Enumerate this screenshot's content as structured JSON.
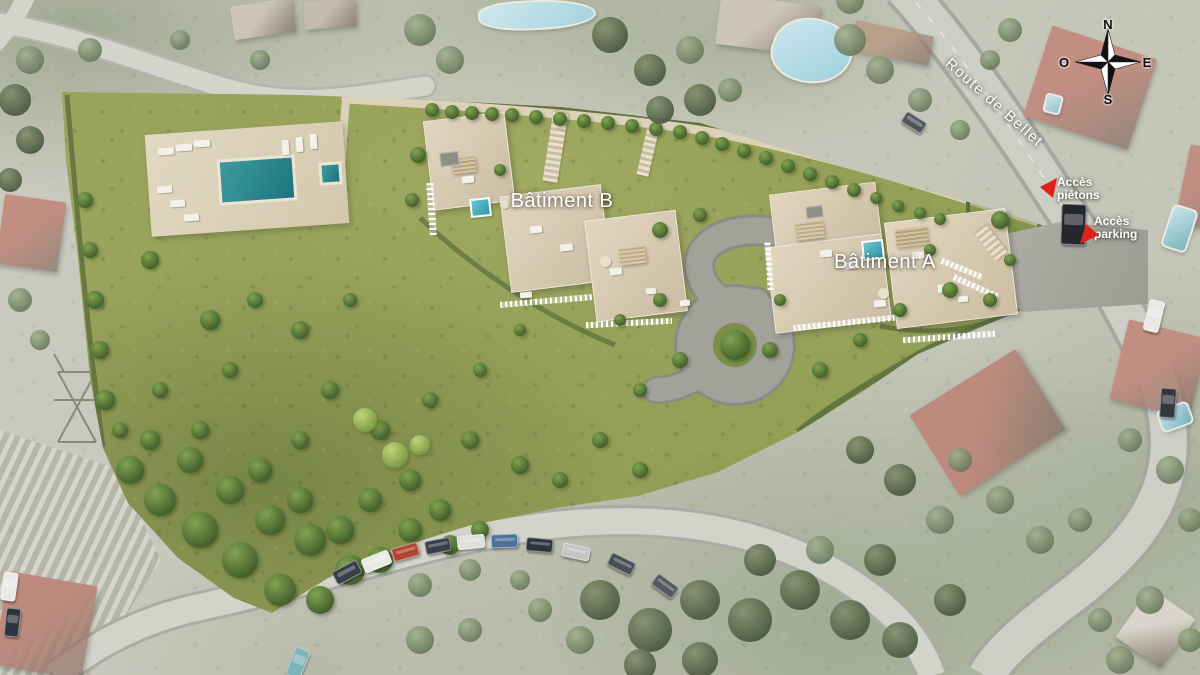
{
  "labels": {
    "building_b": "Bâtiment B",
    "building_a": "Bâtiment A",
    "street": "Route de Bellet",
    "access_pedestrian": {
      "line1": "Accès",
      "line2": "piétons"
    },
    "access_parking": {
      "line1": "Accès",
      "line2": "parking"
    }
  },
  "compass": {
    "north": "N",
    "east": "E",
    "south": "S",
    "west": "O"
  },
  "colors": {
    "accent_arrow_red": "#e0211d",
    "site_green": "#96a158",
    "pool_teal": "#2c8f98",
    "road_gray": "#cdcec6",
    "roof_red": "#c28e82",
    "label_white": "#ffffff"
  }
}
